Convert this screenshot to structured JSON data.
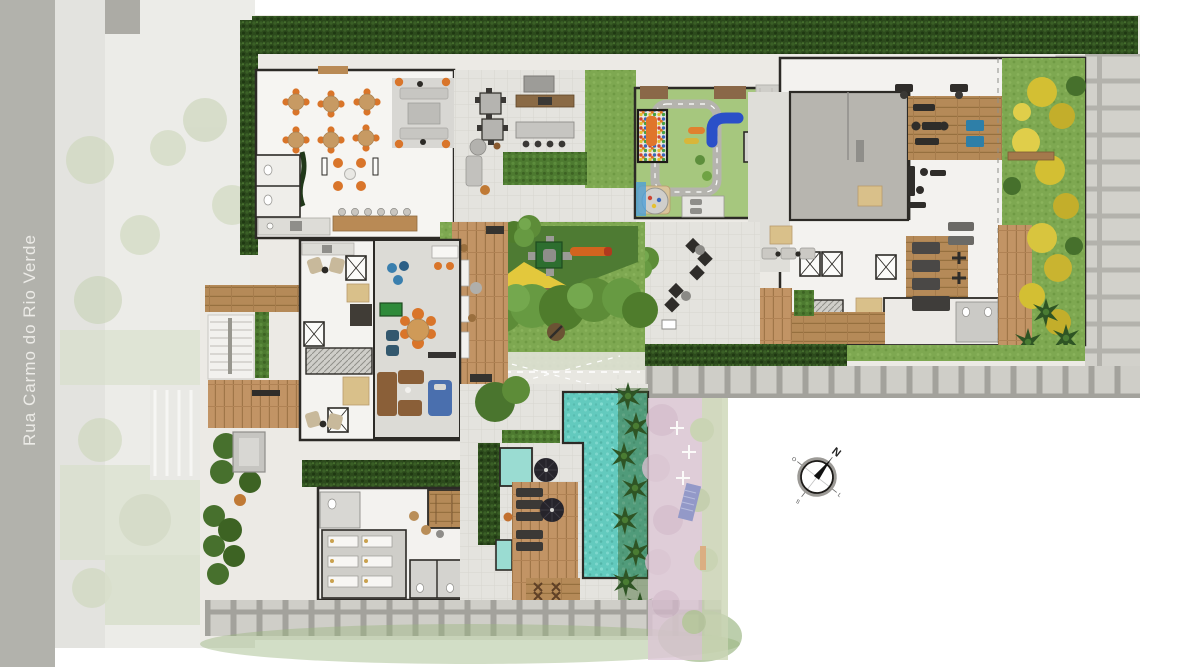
{
  "street": {
    "name": "Rua Carmo do Rio Verde"
  },
  "compass": {
    "north": "N",
    "west": "O",
    "south": "S",
    "east": "L"
  },
  "palette": {
    "street_gray": "#b2b2ac",
    "ghost_pavement": "#ebebe7",
    "hedge_dark_green": "#2c4a1c",
    "lawn_green": "#7ea851",
    "canopy_green": "#5d8c38",
    "yellow_shrubs": "#d3bf33",
    "floor_white": "#f4f3f0",
    "wall_dark": "#2c2a26",
    "wood_deck": "#c29465",
    "gym_wood": "#a87e4e",
    "pool_water": "#63cabe",
    "kids_pool": "#9adcd2",
    "playground_floor": "#a6c77e",
    "slide_orange": "#e0762b",
    "slide_blue": "#2a50c8",
    "chair_orange": "#d9752a",
    "paver_slab": "#d2d1cb",
    "neighbor_pink": "#ddc7d6",
    "neighbor_green": "#ccd6b6",
    "core_gray": "#b7b5af"
  }
}
